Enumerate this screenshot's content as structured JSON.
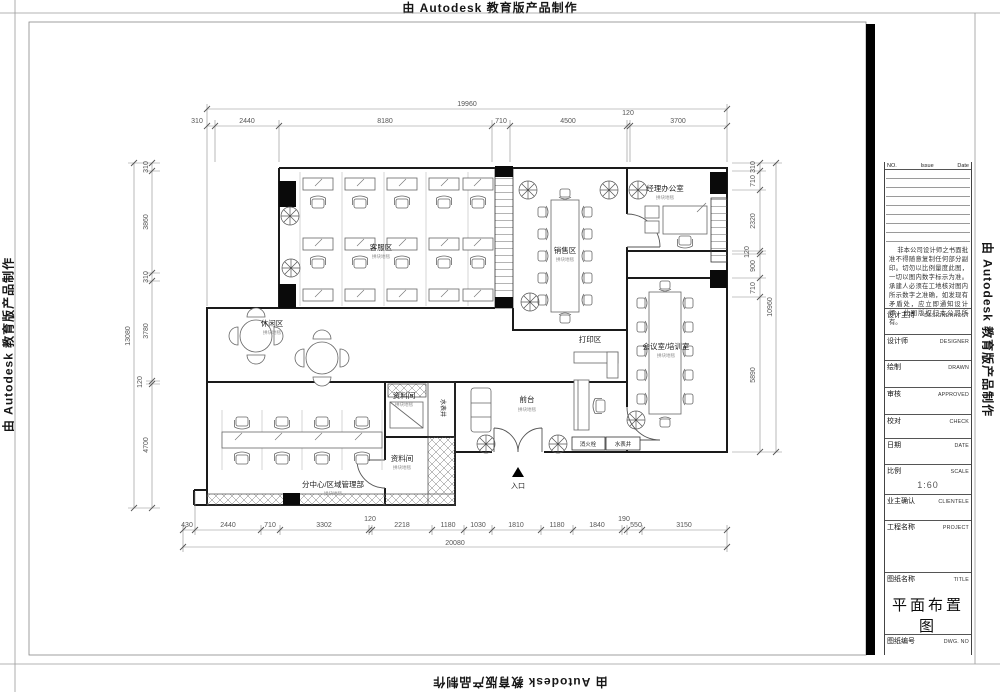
{
  "watermark": {
    "text": "由 Autodesk 教育版产品制作"
  },
  "plan": {
    "rooms": {
      "customer_service": {
        "name": "客服区",
        "sub": "拼块地毯"
      },
      "sales": {
        "name": "销售区",
        "sub": "拼块地毯"
      },
      "manager": {
        "name": "经理办公室",
        "sub": "拼块地毯"
      },
      "leisure": {
        "name": "休闲区",
        "sub": "拼块地毯"
      },
      "print": {
        "name": "打印区"
      },
      "meeting": {
        "name": "会议室/培训室",
        "sub": "拼块地毯"
      },
      "reception": {
        "name": "前台",
        "sub": "拼块地毯"
      },
      "archive1": {
        "name": "资料间",
        "sub": "拼块地毯"
      },
      "archive2": {
        "name": "资料间",
        "sub": "拼块地毯"
      },
      "branch": {
        "name": "分中心/区域管理部",
        "sub": "拼块地毯"
      },
      "entrance": {
        "name": "入口"
      },
      "water_shaft": {
        "name": "水表井"
      },
      "hydrant_box": {
        "name": "消火栓"
      },
      "meter_box": {
        "name": "水表井"
      }
    },
    "dims": {
      "top": {
        "total": "19960",
        "segments": [
          "310",
          "2440",
          "8180",
          "710",
          "4500",
          "120",
          "3700"
        ]
      },
      "bottom": {
        "total": "20080",
        "segments": [
          "430",
          "2440",
          "710",
          "3302",
          "120",
          "2218",
          "1180",
          "1030",
          "1810",
          "1180",
          "1840",
          "190",
          "550",
          "3150"
        ]
      },
      "left": {
        "total": "13080",
        "segments": [
          "310",
          "3860",
          "310",
          "3780",
          "120",
          "4700"
        ]
      },
      "right": {
        "total": "10960",
        "segments": [
          "310",
          "710",
          "2320",
          "120",
          "900",
          "710",
          "5890"
        ]
      }
    }
  },
  "title_block": {
    "revision": {
      "no": "NO.",
      "issue": "Issue",
      "date": "Date"
    },
    "note": "非本公司设计师之书面批准不得随意复制任何部分副印。切勿以比例量度此图，一切以图内数字标示为准。承建人必须在工地核对图内所示数字之准确，如发现有矛盾处，应立即通知设计师，此图版权归本公司所有。",
    "fields": [
      {
        "label": "设计主持",
        "en": "DESIGNERHOST"
      },
      {
        "label": "设计师",
        "en": "DESIGNER"
      },
      {
        "label": "绘制",
        "en": "DRAWN"
      },
      {
        "label": "审核",
        "en": "APPROVED"
      },
      {
        "label": "校对",
        "en": "CHECK"
      },
      {
        "label": "日期",
        "en": "DATE"
      },
      {
        "label": "比例",
        "en": "SCALE",
        "value": "1:60"
      },
      {
        "label": "业主确认",
        "en": "CLIENTELE"
      },
      {
        "label": "工程名称",
        "en": "PROJECT"
      },
      {
        "label": "图纸名称",
        "en": "TITLE",
        "value": "平面布置图"
      },
      {
        "label": "图纸编号",
        "en": "DWG. NO"
      }
    ]
  }
}
